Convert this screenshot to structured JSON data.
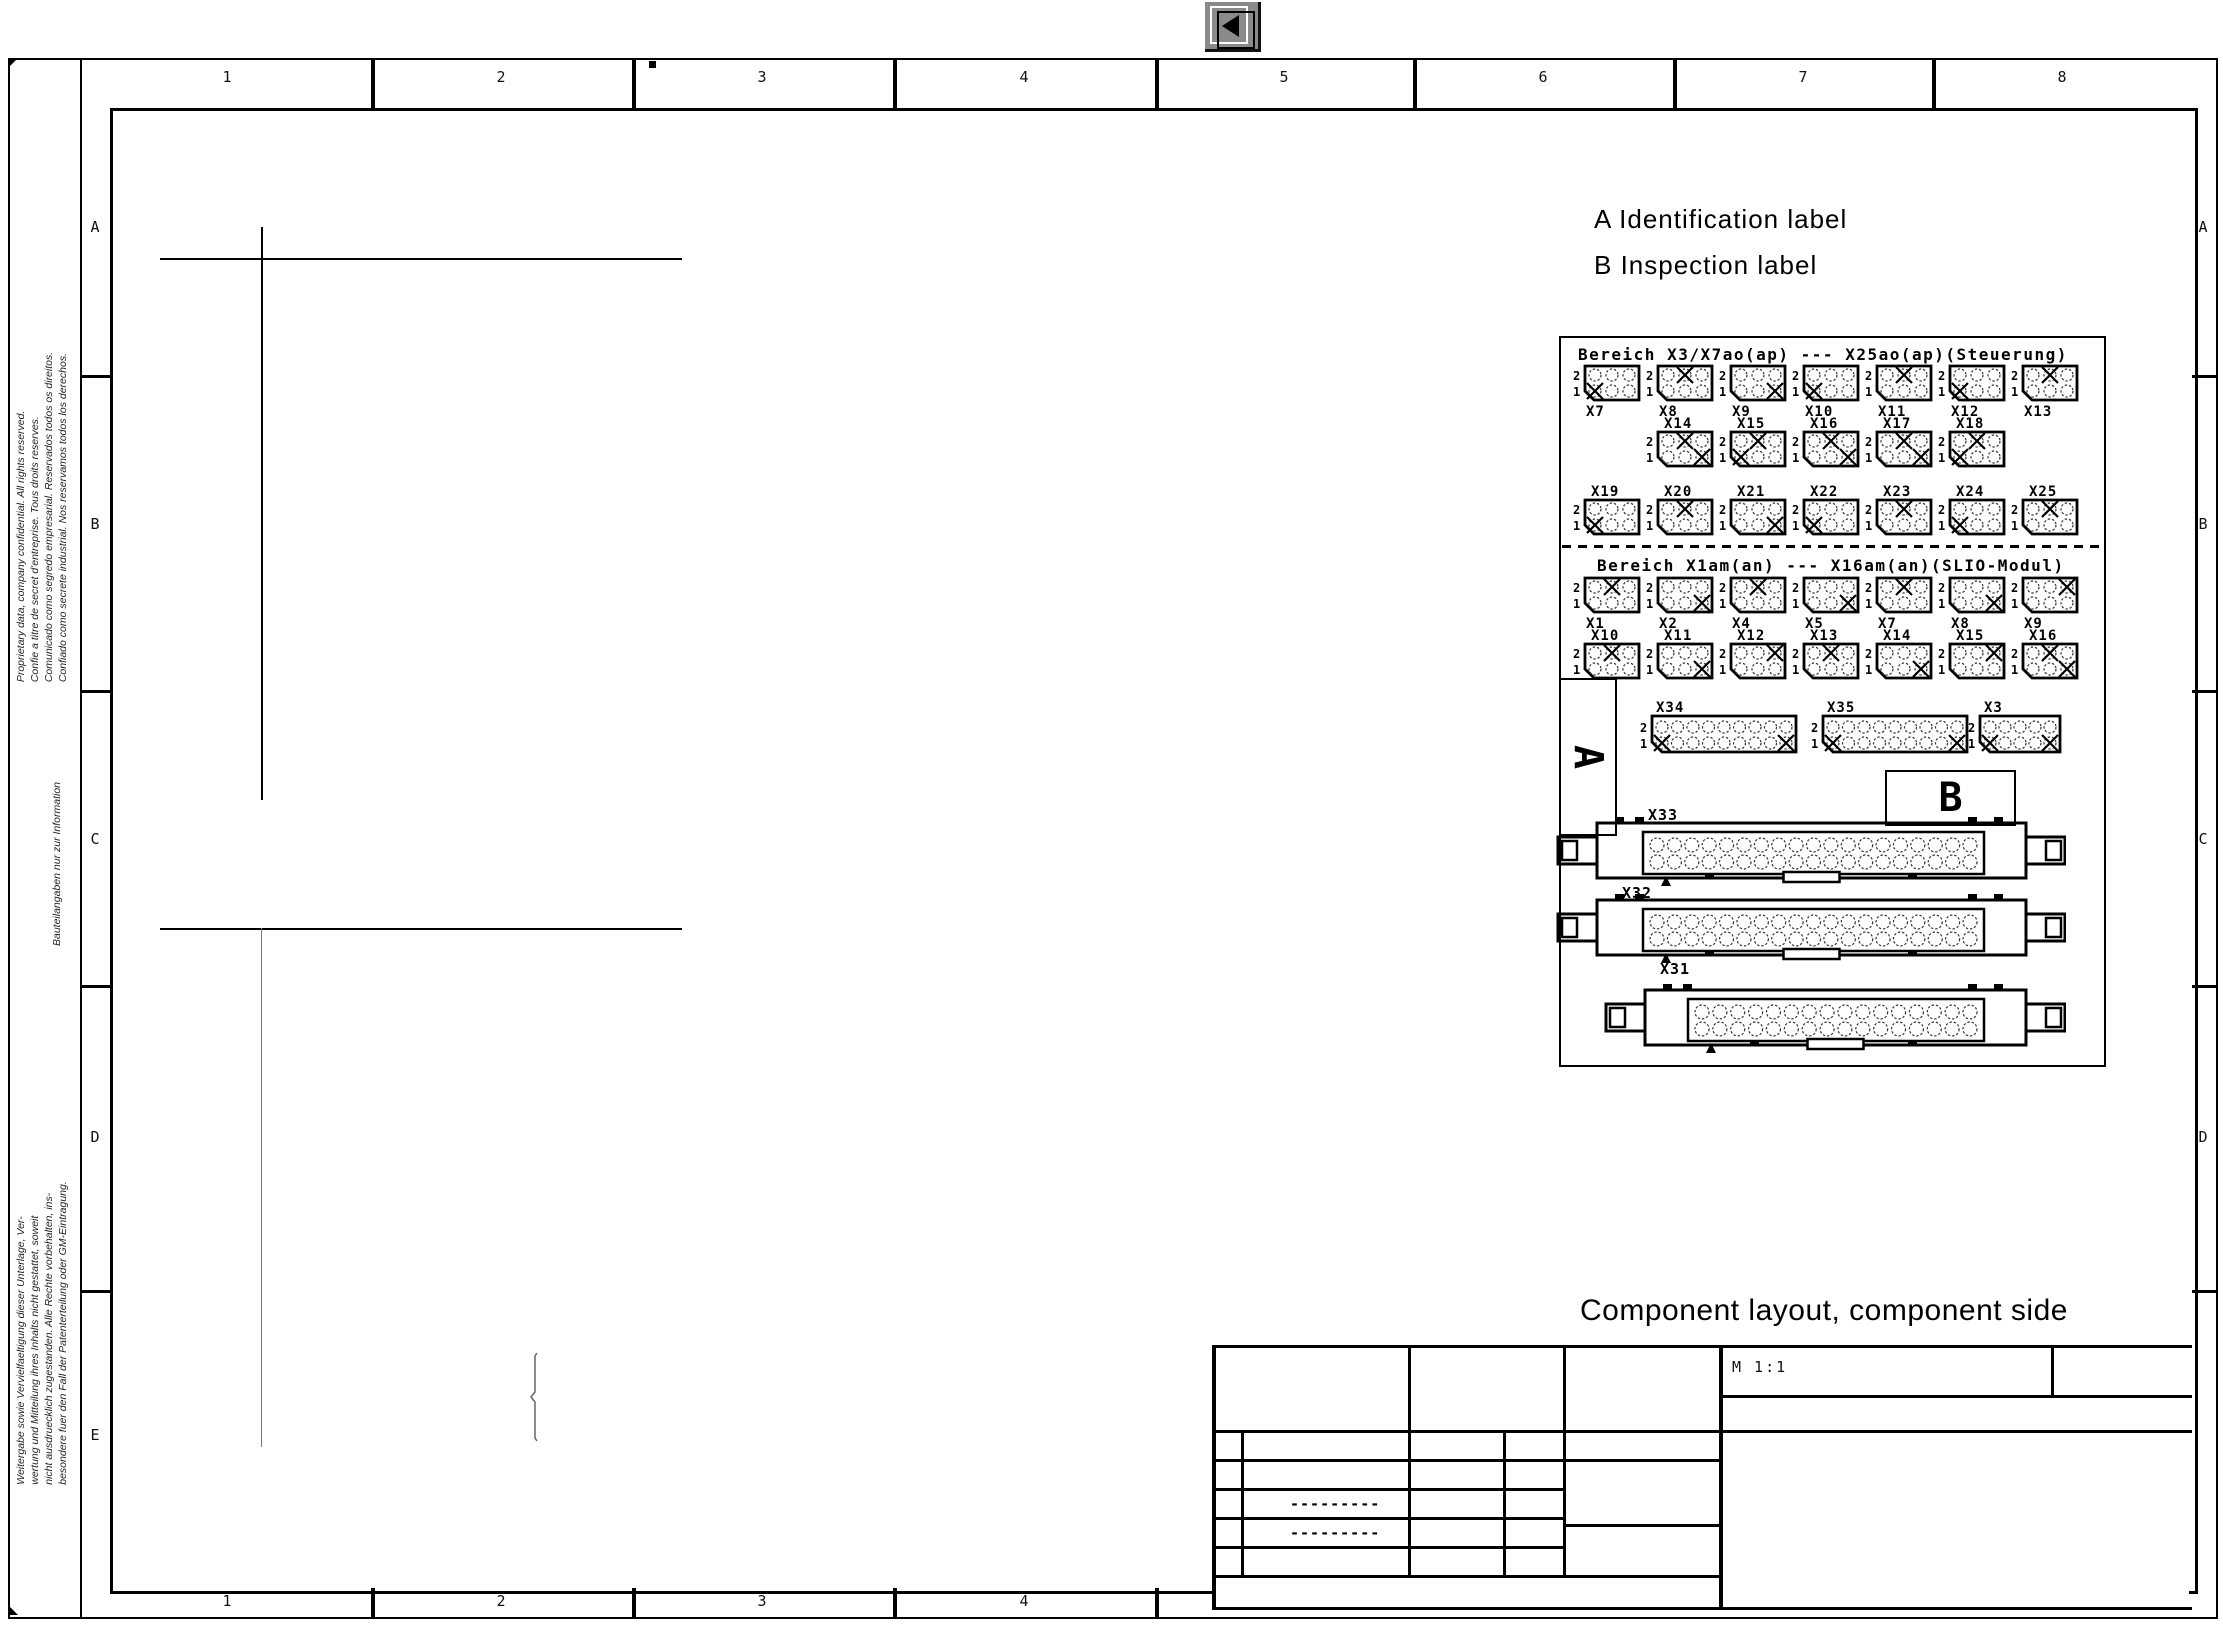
{
  "toolbar": {
    "back_label": "back"
  },
  "sheet": {
    "top_numbers": [
      "1",
      "2",
      "3",
      "4",
      "5",
      "6",
      "7",
      "8"
    ],
    "bottom_numbers": [
      "1",
      "2",
      "3",
      "4"
    ],
    "left_letters": [
      "A",
      "B",
      "C",
      "D",
      "E"
    ],
    "right_letters": [
      "A",
      "B",
      "C",
      "D"
    ]
  },
  "margin_notes": {
    "proprietary_lines": [
      "Proprietary data,  company confidential.  All rights reserved.",
      "Confie a titre de secret d'entreprise. Tous droits reserves.",
      "Comunicado como segredo empresarial. Reservados todos os direitos.",
      "Confiado como secrete industrial. Nos reservamos todos los derechos."
    ],
    "info_note": "Bauteilangaben nur zur Information",
    "legal_lines": [
      "Weitergabe sowie Vervielfaeltigung dieser Unterlage, Ver-",
      "wertung und Mitteilung ihres Inhalts nicht gestattet, soweit",
      "nicht ausdruecklich zugestanden. Alle Rechte vorbehalten, ins-",
      "besondere fuer den Fall der Patenterteilung oder GM-Eintragung."
    ]
  },
  "legend": {
    "line_a": "A Identification label",
    "line_b": "B Inspection label"
  },
  "caption": "Component layout, component side",
  "title_block": {
    "scale": "M 1:1",
    "dash_row_1": "---------",
    "dash_row_2": "---------"
  },
  "diagram": {
    "pin_high": "2",
    "pin_low": "1",
    "area_label_a": "A",
    "area_label_b": "B",
    "sections": [
      {
        "header": "Bereich X3/X7ao(ap) --- X25ao(ap)(Steuerung)",
        "rows": [
          {
            "labels": "below",
            "connectors": [
              {
                "name": "X7",
                "marks": [
                  [
                    1,
                    1
                  ]
                ]
              },
              {
                "name": "X8",
                "marks": [
                  [
                    2,
                    2
                  ]
                ]
              },
              {
                "name": "X9",
                "marks": [
                  [
                    1,
                    3
                  ]
                ]
              },
              {
                "name": "X10",
                "marks": [
                  [
                    1,
                    1
                  ]
                ]
              },
              {
                "name": "X11",
                "marks": [
                  [
                    2,
                    2
                  ]
                ]
              },
              {
                "name": "X12",
                "marks": [
                  [
                    1,
                    1
                  ]
                ]
              },
              {
                "name": "X13",
                "marks": [
                  [
                    2,
                    2
                  ]
                ]
              }
            ]
          },
          {
            "labels": "above",
            "connectors": [
              {
                "name": "X14",
                "marks": [
                  [
                    2,
                    2
                  ],
                  [
                    1,
                    3
                  ]
                ]
              },
              {
                "name": "X15",
                "marks": [
                  [
                    2,
                    2
                  ],
                  [
                    1,
                    1
                  ]
                ]
              },
              {
                "name": "X16",
                "marks": [
                  [
                    2,
                    2
                  ],
                  [
                    1,
                    3
                  ]
                ]
              },
              {
                "name": "X17",
                "marks": [
                  [
                    2,
                    2
                  ],
                  [
                    1,
                    3
                  ]
                ]
              },
              {
                "name": "X18",
                "marks": [
                  [
                    2,
                    2
                  ],
                  [
                    1,
                    1
                  ]
                ]
              }
            ]
          },
          {
            "labels": "above",
            "connectors": [
              {
                "name": "X19",
                "marks": [
                  [
                    1,
                    1
                  ]
                ]
              },
              {
                "name": "X20",
                "marks": [
                  [
                    2,
                    2
                  ]
                ]
              },
              {
                "name": "X21",
                "marks": [
                  [
                    1,
                    3
                  ]
                ]
              },
              {
                "name": "X22",
                "marks": [
                  [
                    1,
                    1
                  ]
                ]
              },
              {
                "name": "X23",
                "marks": [
                  [
                    2,
                    2
                  ]
                ]
              },
              {
                "name": "X24",
                "marks": [
                  [
                    1,
                    1
                  ]
                ]
              },
              {
                "name": "X25",
                "marks": [
                  [
                    2,
                    2
                  ]
                ]
              }
            ]
          }
        ]
      },
      {
        "header": "Bereich X1am(an) --- X16am(an)(SLIO-Modul)",
        "rows": [
          {
            "labels": "below",
            "connectors": [
              {
                "name": "X1",
                "marks": [
                  [
                    2,
                    2
                  ]
                ]
              },
              {
                "name": "X2",
                "marks": [
                  [
                    1,
                    3
                  ]
                ]
              },
              {
                "name": "X4",
                "marks": [
                  [
                    2,
                    2
                  ]
                ]
              },
              {
                "name": "X5",
                "marks": [
                  [
                    1,
                    3
                  ]
                ]
              },
              {
                "name": "X7",
                "marks": [
                  [
                    2,
                    2
                  ]
                ]
              },
              {
                "name": "X8",
                "marks": [
                  [
                    1,
                    3
                  ]
                ]
              },
              {
                "name": "X9",
                "marks": [
                  [
                    2,
                    3
                  ]
                ]
              }
            ]
          },
          {
            "labels": "above",
            "connectors": [
              {
                "name": "X10",
                "marks": [
                  [
                    2,
                    2
                  ]
                ]
              },
              {
                "name": "X11",
                "marks": [
                  [
                    1,
                    3
                  ]
                ]
              },
              {
                "name": "X12",
                "marks": [
                  [
                    2,
                    3
                  ]
                ]
              },
              {
                "name": "X13",
                "marks": [
                  [
                    2,
                    2
                  ]
                ]
              },
              {
                "name": "X14",
                "marks": [
                  [
                    1,
                    3
                  ]
                ]
              },
              {
                "name": "X15",
                "marks": [
                  [
                    2,
                    3
                  ]
                ]
              },
              {
                "name": "X16",
                "marks": [
                  [
                    2,
                    2
                  ],
                  [
                    1,
                    3
                  ]
                ]
              }
            ]
          }
        ]
      }
    ],
    "strip_connectors": [
      {
        "name": "X34",
        "pins": 9,
        "marks": [
          [
            1,
            1
          ],
          [
            1,
            9
          ]
        ]
      },
      {
        "name": "X35",
        "pins": 9,
        "marks": [
          [
            1,
            1
          ],
          [
            1,
            9
          ]
        ]
      },
      {
        "name": "X3",
        "pins": 5,
        "marks": [
          [
            1,
            1
          ],
          [
            1,
            5
          ]
        ]
      }
    ],
    "din_connectors": [
      {
        "name": "X33",
        "pins": 19
      },
      {
        "name": "X32",
        "pins": 19
      },
      {
        "name": "X31",
        "pins": 16
      }
    ]
  }
}
